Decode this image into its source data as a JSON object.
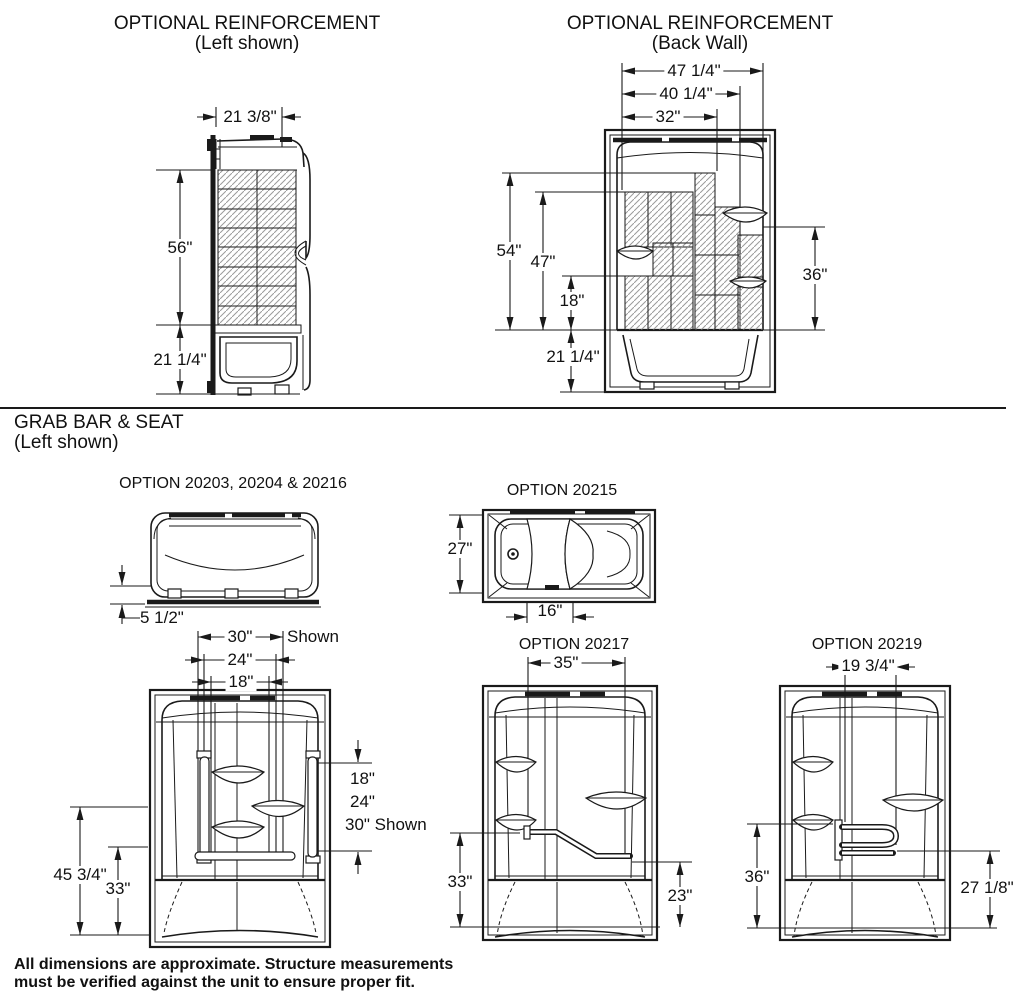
{
  "reinforcement_left": {
    "title": "OPTIONAL REINFORCEMENT",
    "subtitle": "(Left shown)",
    "width": "21 3/8\"",
    "height": "56\"",
    "base": "21 1/4\""
  },
  "reinforcement_back": {
    "title": "OPTIONAL REINFORCEMENT",
    "subtitle": "(Back Wall)",
    "widths": [
      "47 1/4\"",
      "40 1/4\"",
      "32\""
    ],
    "heights": [
      "54\"",
      "47\"",
      "18\""
    ],
    "right": "36\"",
    "base": "21 1/4\""
  },
  "grab_bar_seat": {
    "title": "GRAB BAR & SEAT",
    "subtitle": "(Left shown)"
  },
  "option_a": {
    "label": "OPTION 20203, 20204 & 20216",
    "rim": "5 1/2\"",
    "top_dims": [
      "30\"",
      "24\"",
      "18\""
    ],
    "top_suffix": "Shown",
    "right_dims": [
      "18\"",
      "24\"",
      "30\" Shown"
    ],
    "left_dims": [
      "45 3/4\"",
      "33\""
    ]
  },
  "option_b": {
    "label": "OPTION 20215",
    "depth": "27\"",
    "seat": "16\""
  },
  "option_c": {
    "label": "OPTION 20217",
    "width": "35\"",
    "left": "33\"",
    "right": "23\""
  },
  "option_d": {
    "label": "OPTION 20219",
    "width": "19 3/4\"",
    "left": "36\"",
    "right": "27 1/8\""
  },
  "footer": {
    "line1": "All dimensions are approximate. Structure measurements",
    "line2": "must be verified against the unit to ensure proper fit."
  }
}
